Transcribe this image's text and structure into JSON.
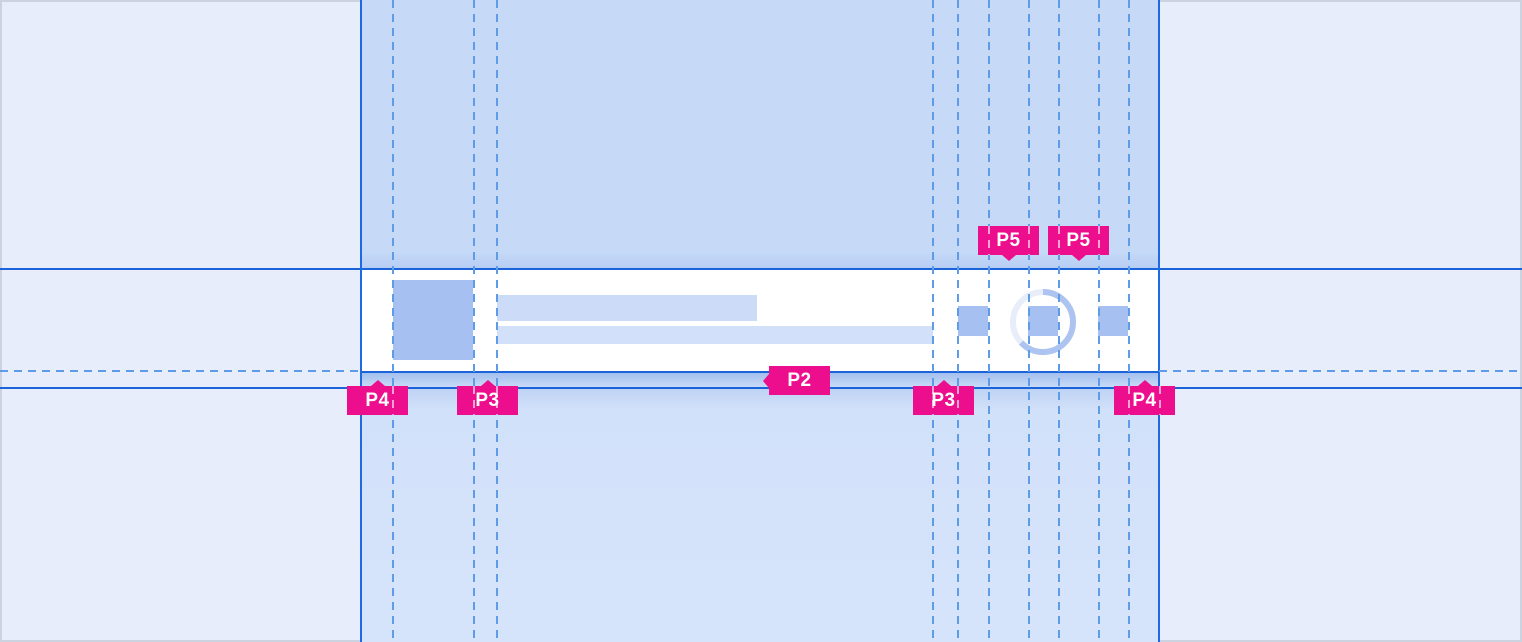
{
  "badges": [
    {
      "id": "p4-left",
      "label": "P4",
      "x": 347,
      "y": 386,
      "pointer": "up",
      "stripes": [
        45
      ]
    },
    {
      "id": "p3-left",
      "label": "P3",
      "x": 457,
      "y": 386,
      "pointer": "up",
      "stripes": [
        16,
        39
      ]
    },
    {
      "id": "p2",
      "label": "P2",
      "x": 769,
      "y": 366,
      "pointer": "left",
      "stripes": []
    },
    {
      "id": "p3-right",
      "label": "P3",
      "x": 913,
      "y": 386,
      "pointer": "up",
      "stripes": [
        19,
        44
      ]
    },
    {
      "id": "p4-right",
      "label": "P4",
      "x": 1114,
      "y": 386,
      "pointer": "up",
      "stripes": [
        14,
        45
      ]
    },
    {
      "id": "p5-left",
      "label": "P5",
      "x": 978,
      "y": 226,
      "pointer": "down",
      "stripes": [
        10,
        50
      ]
    },
    {
      "id": "p5-right",
      "label": "P5",
      "x": 1048,
      "y": 226,
      "pointer": "down",
      "stripes": [
        10,
        50
      ]
    }
  ],
  "guides": {
    "vertical_x": [
      392,
      473,
      496,
      932,
      957,
      988,
      1028,
      1058,
      1098,
      1128
    ],
    "horizontal_dash_y": 370
  },
  "progress_ring": {
    "percent_filled": 63
  },
  "colors": {
    "badge_pink": "#ec0e8d",
    "badge_text": "#ffffff",
    "guide_blue": "#5f9ce8",
    "spec_line_blue": "#1a63d9",
    "column_edge_blue": "#1f6ae2",
    "placeholder_blue": "#a6c0f2",
    "text_bar_blue": "#ccdcf8",
    "column_top_blue": "#c6daf8",
    "column_bottom_blue": "#d4e3fb",
    "canvas_blue": "#e8edfb",
    "card_white": "#ffffff",
    "ring_track": "#e8edfa",
    "ring_arc": "#adc4f0"
  }
}
